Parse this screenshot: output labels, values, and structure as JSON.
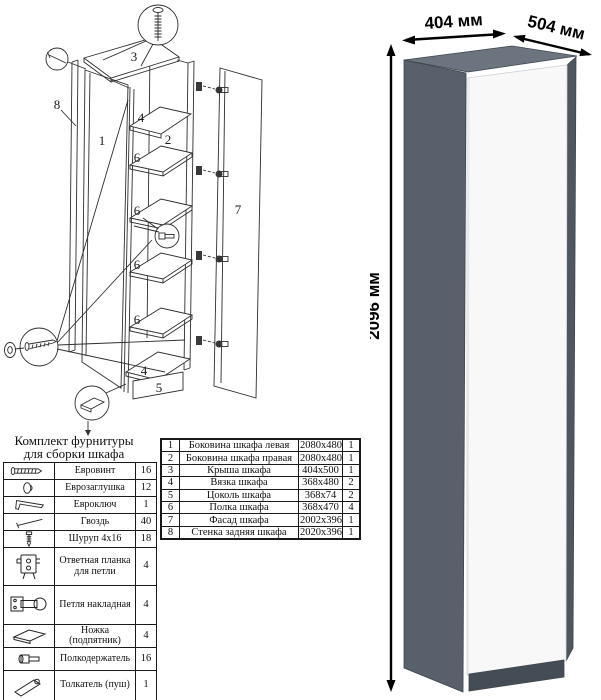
{
  "diagram": {
    "kit_title_line1": "Комплект фурнитуры",
    "kit_title_line2": "для сборки шкафа",
    "part_labels": {
      "top_panel": "3",
      "back_panel": "8",
      "left_side": "1",
      "right_side": "2",
      "top_brace": "4",
      "bottom_brace": "4",
      "plinth": "5",
      "door": "7",
      "shelf_1": "6",
      "shelf_2": "6",
      "shelf_3": "6",
      "shelf_4": "6"
    }
  },
  "hardware_table": {
    "rows": [
      {
        "icon": "euro-screw-icon",
        "name": "Евровинт",
        "qty": "16"
      },
      {
        "icon": "euro-cap-icon",
        "name": "Еврозаглушка",
        "qty": "12"
      },
      {
        "icon": "euro-key-icon",
        "name": "Евроключ",
        "qty": "1"
      },
      {
        "icon": "nail-icon",
        "name": "Гвоздь",
        "qty": "40"
      },
      {
        "icon": "screw-icon",
        "name": "Шуруп 4x16",
        "qty": "18"
      },
      {
        "icon": "strike-plate-icon",
        "name": "Ответная планка для петли",
        "qty": "4"
      },
      {
        "icon": "hinge-icon",
        "name": "Петля накладная",
        "qty": "4"
      },
      {
        "icon": "foot-icon",
        "name": "Ножка (подпятник)",
        "qty": "4"
      },
      {
        "icon": "shelf-pin-icon",
        "name": "Полкодержатель",
        "qty": "16"
      },
      {
        "icon": "push-latch-icon",
        "name": "Толкатель (пуш)",
        "qty": "1"
      }
    ]
  },
  "parts_table": {
    "rows": [
      {
        "num": "1",
        "name": "Боковина шкафа левая",
        "size": "2080x480",
        "qty": "1"
      },
      {
        "num": "2",
        "name": "Боковина шкафа правая",
        "size": "2080x480",
        "qty": "1"
      },
      {
        "num": "3",
        "name": "Крыша шкафа",
        "size": "404x500",
        "qty": "1"
      },
      {
        "num": "4",
        "name": "Вязка шкафа",
        "size": "368x480",
        "qty": "2"
      },
      {
        "num": "5",
        "name": "Цоколь шкафа",
        "size": "368x74",
        "qty": "2"
      },
      {
        "num": "6",
        "name": "Полка шкафа",
        "size": "368x470",
        "qty": "4"
      },
      {
        "num": "7",
        "name": "Фасад шкафа",
        "size": "2002x396",
        "qty": "1"
      },
      {
        "num": "8",
        "name": "Стенка задняя шкафа",
        "size": "2020x396",
        "qty": "1"
      }
    ]
  },
  "render": {
    "width_label": "404 мм",
    "depth_label": "504 мм",
    "height_label": "2096 мм",
    "colors": {
      "side": "#57606b",
      "top": "#6b747f",
      "door": "#f8f8f8",
      "plinth": "#444c55",
      "edge": "#4e565f"
    }
  }
}
